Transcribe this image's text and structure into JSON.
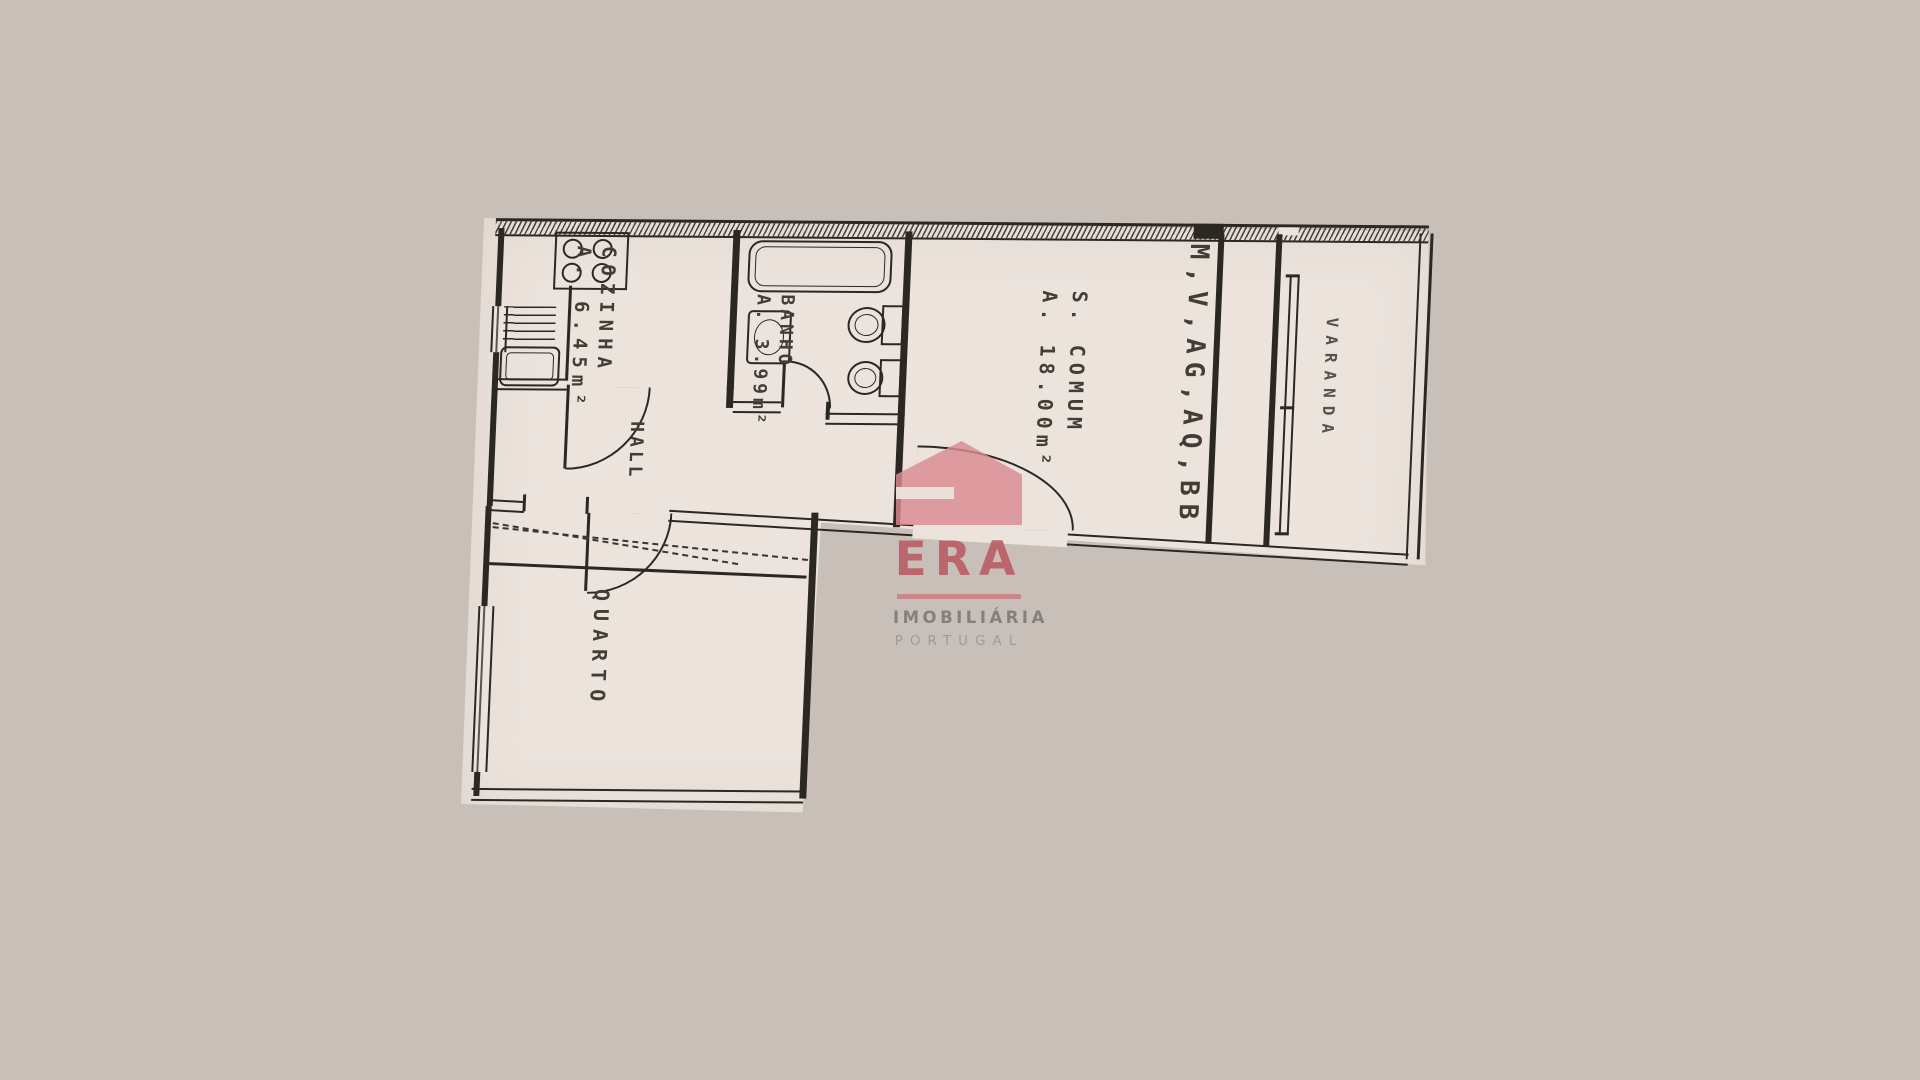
{
  "colors": {
    "background": "#c9bfb9",
    "paper": "#ebe3dc",
    "ink": "#2b2824",
    "label_ink": "#433d35",
    "watermark_pink": "#db8b91",
    "watermark_red": "#b7565e",
    "watermark_gray": "#7c7976"
  },
  "plan": {
    "rooms": [
      {
        "id": "cozinha",
        "label": "COZINHA",
        "area": "A. 6.45m²"
      },
      {
        "id": "banho",
        "label": "BANHO",
        "area": "A. 3.99m²"
      },
      {
        "id": "s_comum",
        "label": "S. COMUM",
        "area": "A. 18.00m²"
      },
      {
        "id": "hall",
        "label": "HALL",
        "area": ""
      },
      {
        "id": "quarto",
        "label": "QUARTO",
        "area": ""
      },
      {
        "id": "varanda",
        "label": "VARANDA",
        "area": ""
      },
      {
        "id": "shaft",
        "label": "M,V,AG,AQ,BB",
        "area": ""
      }
    ]
  },
  "watermark": {
    "brand": "ERA",
    "line1": "IMOBILIÁRIA",
    "line2": "PORTUGAL"
  }
}
